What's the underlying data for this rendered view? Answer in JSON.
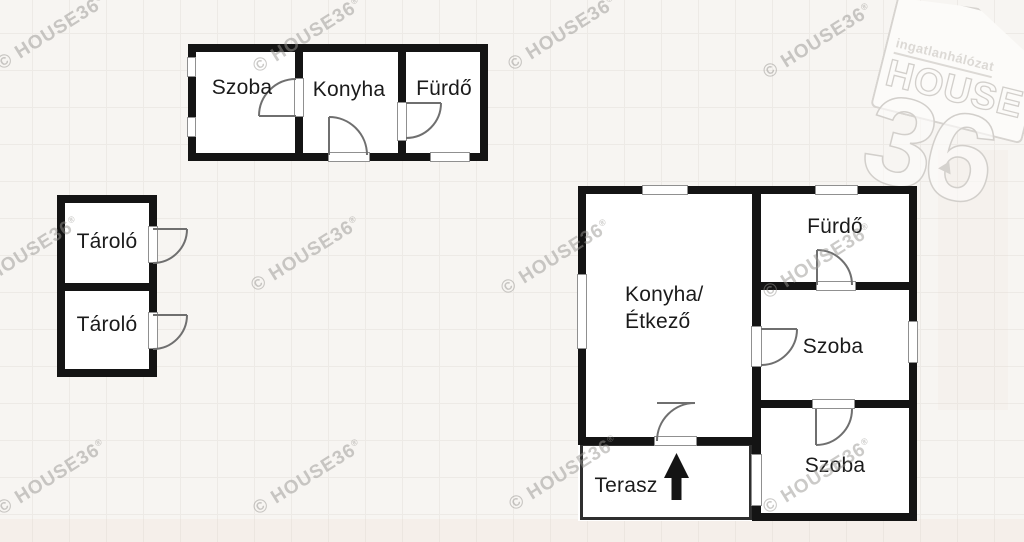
{
  "watermark": {
    "text": "© HOUSE36",
    "sup": "®"
  },
  "logo": {
    "network": "ingatlanhálózat",
    "brand": "HOUSE",
    "number": "36"
  },
  "rooms": {
    "building_top": [
      {
        "label": "Szoba"
      },
      {
        "label": "Konyha"
      },
      {
        "label": "Fürdő"
      }
    ],
    "building_left": [
      {
        "label": "Tároló"
      },
      {
        "label": "Tároló"
      }
    ],
    "building_main": [
      {
        "label": "Konyha/\nÉtkező"
      },
      {
        "label": "Fürdő"
      },
      {
        "label": "Szoba"
      },
      {
        "label": "Szoba"
      },
      {
        "label": "Terasz"
      }
    ]
  },
  "colors": {
    "background": "#f7f5f2",
    "wall": "#141414",
    "window_frame": "#909090",
    "door_arc": "#6f6f6f",
    "label": "#1b1b1b",
    "watermark": "#989591"
  }
}
